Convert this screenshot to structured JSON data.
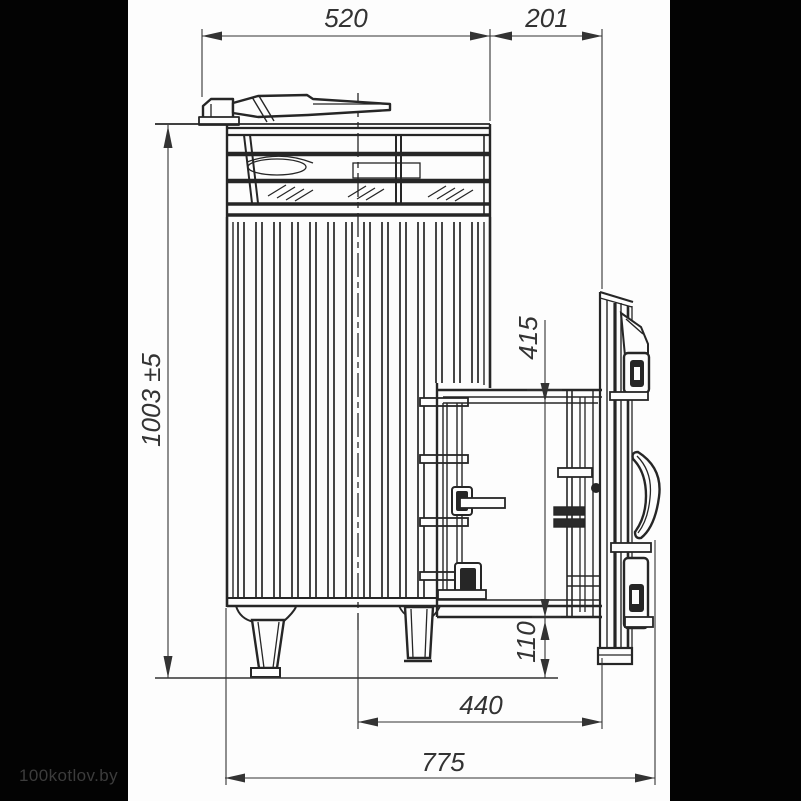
{
  "page": {
    "background": "#fdfdfd",
    "letterbox_color": "#030303",
    "line_color": "#262626"
  },
  "watermark": {
    "text": "100kotlov.by",
    "color": "#3c3c3c"
  },
  "drawing": {
    "subject": "wood-fired sauna stove with stone cage and external firebox tunnel, side-view technical drawing"
  },
  "dims": {
    "top_width": "520",
    "top_offset": "201",
    "overall_height": "1003 ±5",
    "tunnel_height": "415",
    "floor_clearance": "110",
    "axis_to_door": "440",
    "overall_depth": "775"
  }
}
